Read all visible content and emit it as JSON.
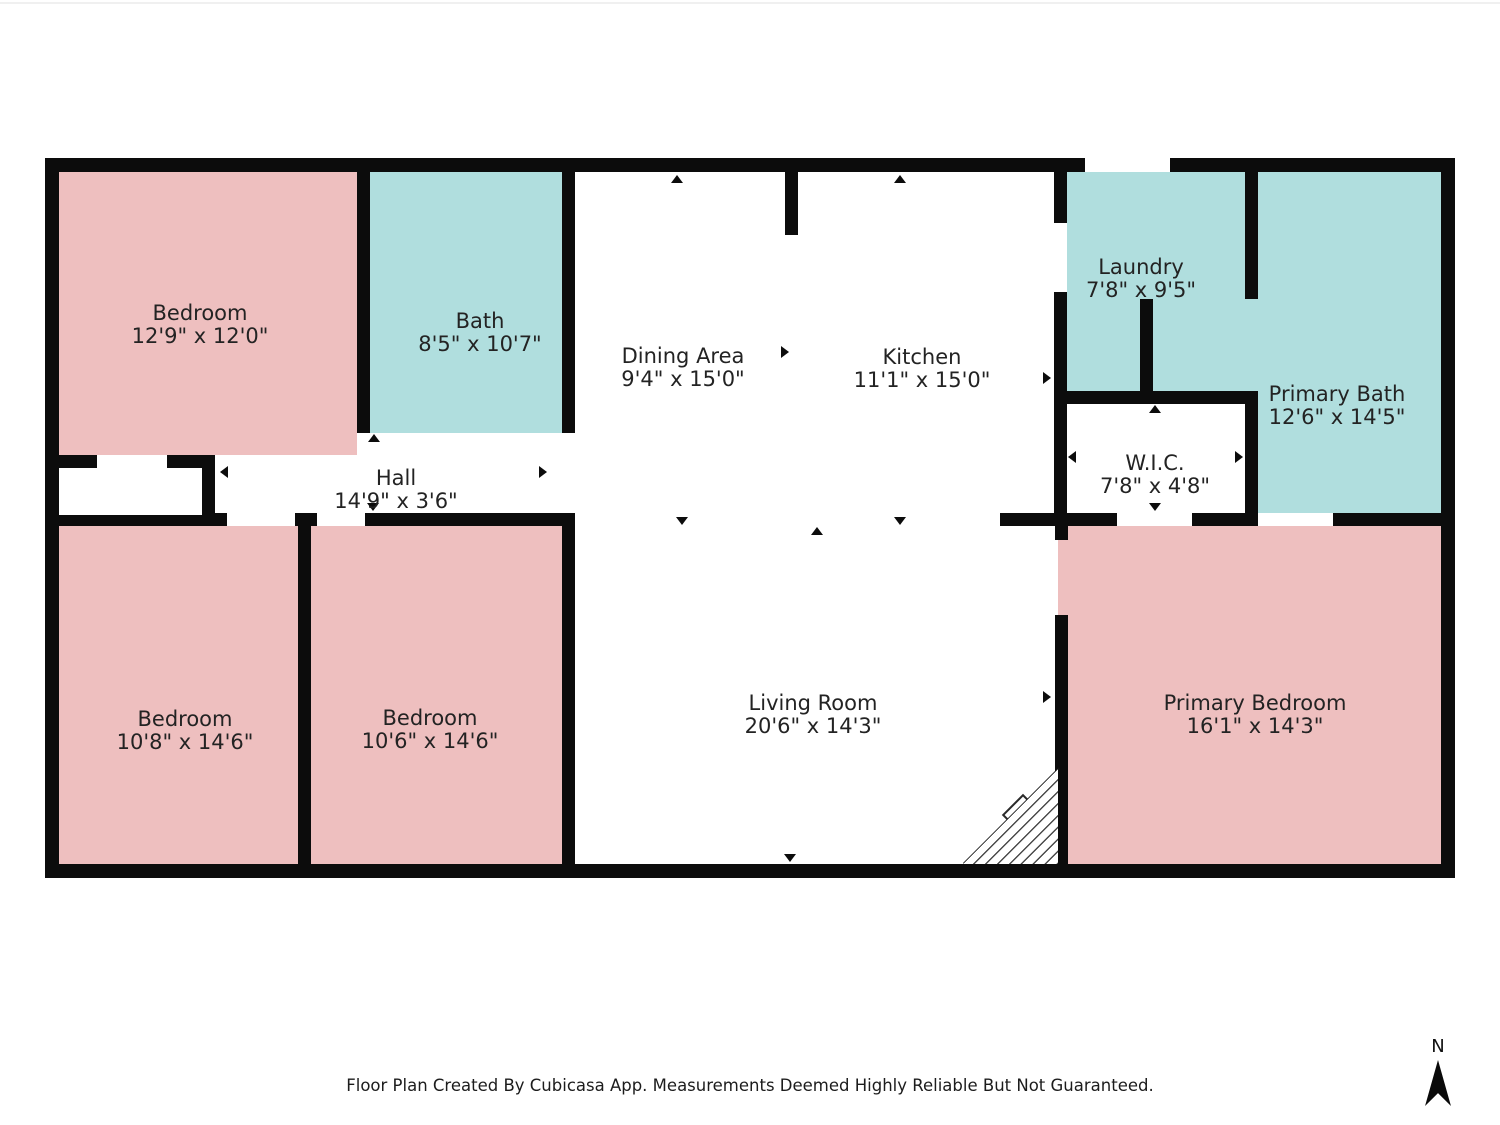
{
  "plan": {
    "colors": {
      "room_pink": "#EEBFBF",
      "room_teal": "#B0DEDE",
      "wall": "#0C0C0C",
      "label_text": "#232323"
    },
    "rooms": [
      {
        "id": "bedroom-top-left",
        "name": "Bedroom",
        "dims": "12'9\" x 12'0\""
      },
      {
        "id": "bath",
        "name": "Bath",
        "dims": "8'5\" x 10'7\""
      },
      {
        "id": "dining-area",
        "name": "Dining Area",
        "dims": "9'4\" x 15'0\""
      },
      {
        "id": "kitchen",
        "name": "Kitchen",
        "dims": "11'1\" x 15'0\""
      },
      {
        "id": "laundry",
        "name": "Laundry",
        "dims": "7'8\" x 9'5\""
      },
      {
        "id": "primary-bath",
        "name": "Primary Bath",
        "dims": "12'6\" x 14'5\""
      },
      {
        "id": "wic",
        "name": "W.I.C.",
        "dims": "7'8\" x 4'8\""
      },
      {
        "id": "hall",
        "name": "Hall",
        "dims": "14'9\" x 3'6\""
      },
      {
        "id": "bedroom-bottom-left",
        "name": "Bedroom",
        "dims": "10'8\" x 14'6\""
      },
      {
        "id": "bedroom-bottom-mid",
        "name": "Bedroom",
        "dims": "10'6\" x 14'6\""
      },
      {
        "id": "living-room",
        "name": "Living Room",
        "dims": "20'6\" x 14'3\""
      },
      {
        "id": "primary-bedroom",
        "name": "Primary Bedroom",
        "dims": "16'1\" x 14'3\""
      }
    ],
    "footer": "Floor Plan Created By Cubicasa App. Measurements Deemed Highly Reliable But Not Guaranteed.",
    "compass": {
      "label": "N"
    }
  }
}
